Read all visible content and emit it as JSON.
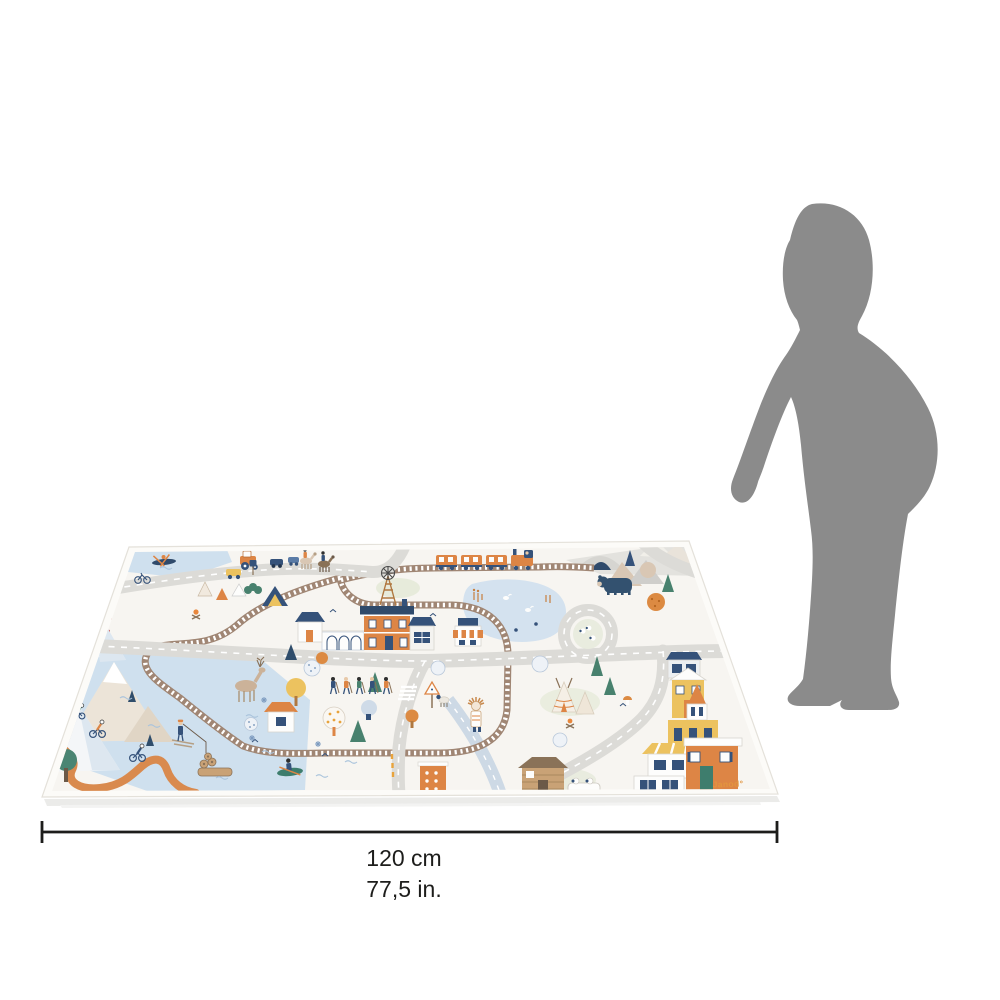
{
  "image": {
    "background": "#ffffff"
  },
  "dimension_annotation": {
    "cm_label": "120 cm",
    "in_label": "77,5 in.",
    "line_color": "#1d1d1b"
  },
  "brand": {
    "signature": "Janod°",
    "color": "#e2953f"
  },
  "silhouette": {
    "label": "toddler-silhouette",
    "color": "#8b8b8b"
  },
  "mat": {
    "base_color": "#f7f5f1",
    "edge_color": "#fcfbf8",
    "palette": {
      "road": "#dcdbd7",
      "road_marking": "#ffffff",
      "rail": "#a08674",
      "rail_ties": "#ffffff",
      "water": "#cfe0ee",
      "pond": "#d4e2ef",
      "orange": "#dd8545",
      "dark_blue": "#35527a",
      "navy": "#2f4a6b",
      "green": "#48816e",
      "yellow": "#ecc25f",
      "beige": "#d9c7b4",
      "trail": "#d98a4e",
      "sand": "#ece4d8"
    },
    "features": [
      "railway-loop",
      "train",
      "train-tunnel",
      "train-station",
      "windmill",
      "pond",
      "roundabout",
      "roads",
      "crosswalk",
      "mountains",
      "lake",
      "campsite-tents",
      "teepees",
      "church",
      "houses",
      "log-cabin",
      "deer",
      "bear",
      "hikers",
      "cyclists",
      "kayaker",
      "fisherman",
      "horse-riders",
      "tractor",
      "cars",
      "canoe",
      "bicycle",
      "trees",
      "logs",
      "sheep"
    ]
  }
}
